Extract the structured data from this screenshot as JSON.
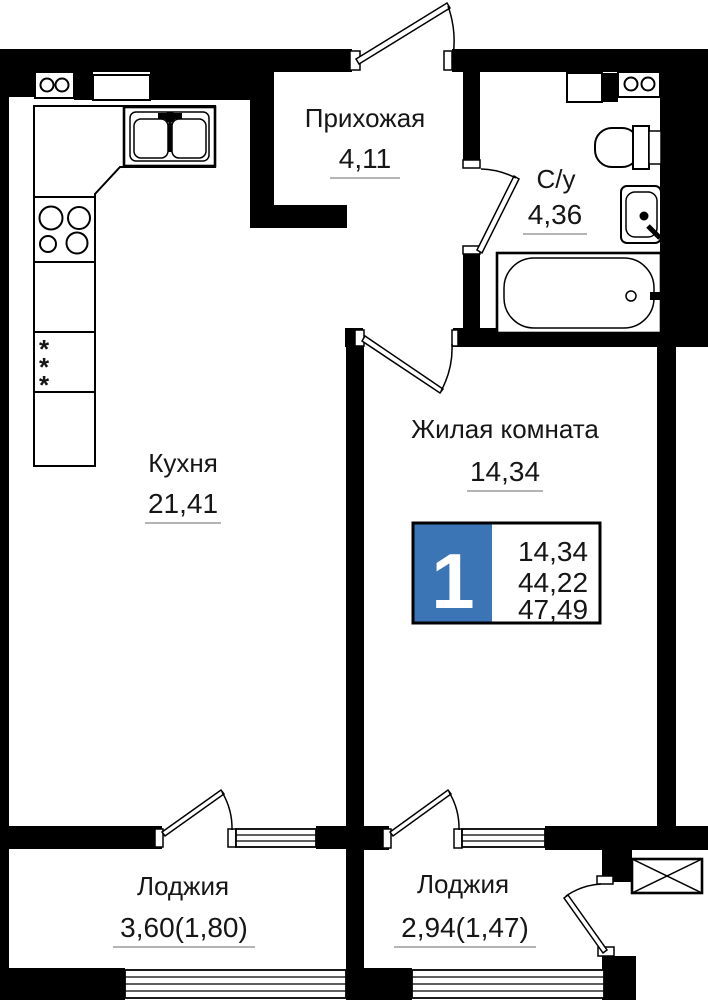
{
  "plan": {
    "rooms": [
      {
        "name": "Прихожая",
        "area": "4,11"
      },
      {
        "name": "С/у",
        "area": "4,36"
      },
      {
        "name": "Кухня",
        "area": "21,41"
      },
      {
        "name": "Жилая комната",
        "area": "14,34"
      },
      {
        "name": "Лоджия",
        "area": "3,60(1,80)"
      },
      {
        "name": "Лоджия",
        "area": "2,94(1,47)"
      }
    ],
    "badge": {
      "rooms_count": "1",
      "areas": [
        "14,34",
        "44,22",
        "47,49"
      ]
    },
    "fixtures": {
      "fridge_symbol": "*",
      "icons": [
        "kitchen-sink-icon",
        "stove-icon",
        "fridge-icon",
        "kitchen-cabinet-icon",
        "vent-shaft-icon",
        "toilet-icon",
        "washbasin-icon",
        "bathtub-icon",
        "ac-basket-icon",
        "door-swing-icon",
        "window-icon",
        "loggia-glazing-icon"
      ]
    },
    "colors": {
      "wall": "#000000",
      "badge_blue": "#3C75B5",
      "underline": "#9B9B9B",
      "text": "#161616"
    }
  }
}
